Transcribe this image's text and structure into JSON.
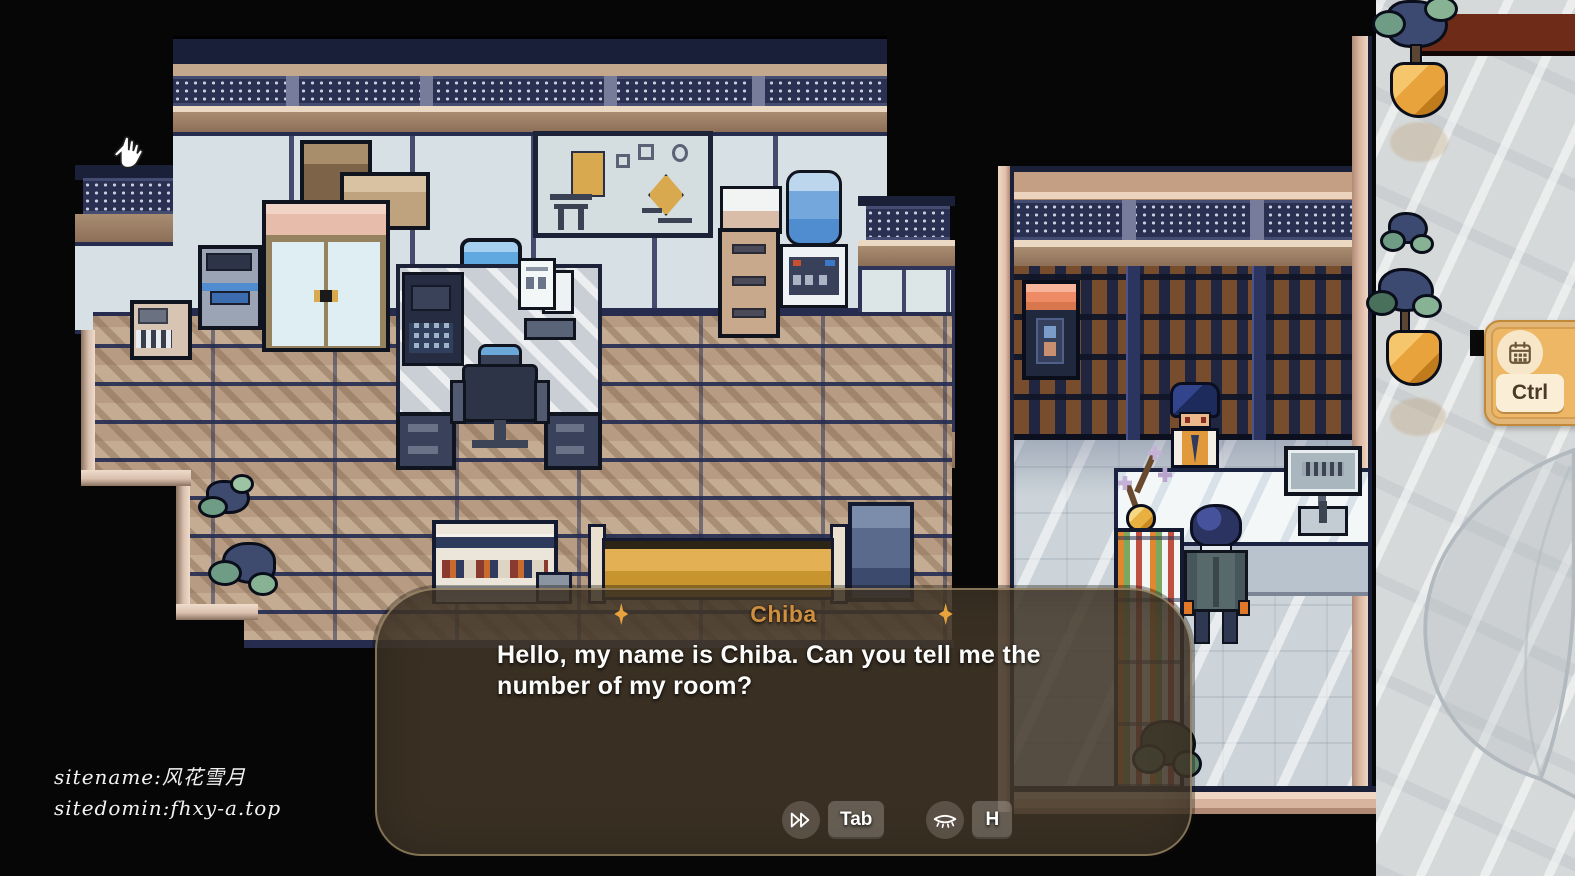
{
  "dialogue": {
    "speaker": "Chiba",
    "text": "Hello, my name is Chiba. Can you tell me the number of my room?",
    "ornament": "sparkle-diamond",
    "speaker_color": "#cf8f3e",
    "box_bg": "rgba(66,55,41,0.86)"
  },
  "controls": {
    "skip": {
      "icon": "fast-forward-icon",
      "key": "Tab"
    },
    "hide": {
      "icon": "eye-closed-icon",
      "key": "H"
    }
  },
  "hotkey_card": {
    "icon": "calendar-icon",
    "key": "Ctrl",
    "bg": "#eeb765"
  },
  "watermark": {
    "line1": "sitename:风花雪月",
    "line2": "sitedomin:fhxy-a.top"
  },
  "scene": {
    "rooms": [
      "office-room",
      "reception-room",
      "outdoor-walkway"
    ],
    "characters": [
      "receptionist-npc",
      "player-character"
    ],
    "palette": {
      "wall_navy": "#262c4e",
      "wood_floor": "#b79c83",
      "tile_floor": "#ccd4d9",
      "beam_tan": "#a98d71",
      "accent_gold": "#e8a33d",
      "bench_gold": "#dca843",
      "plant_pot_orange": "#e8a33c",
      "roof_maroon": "#6e2b18"
    }
  }
}
